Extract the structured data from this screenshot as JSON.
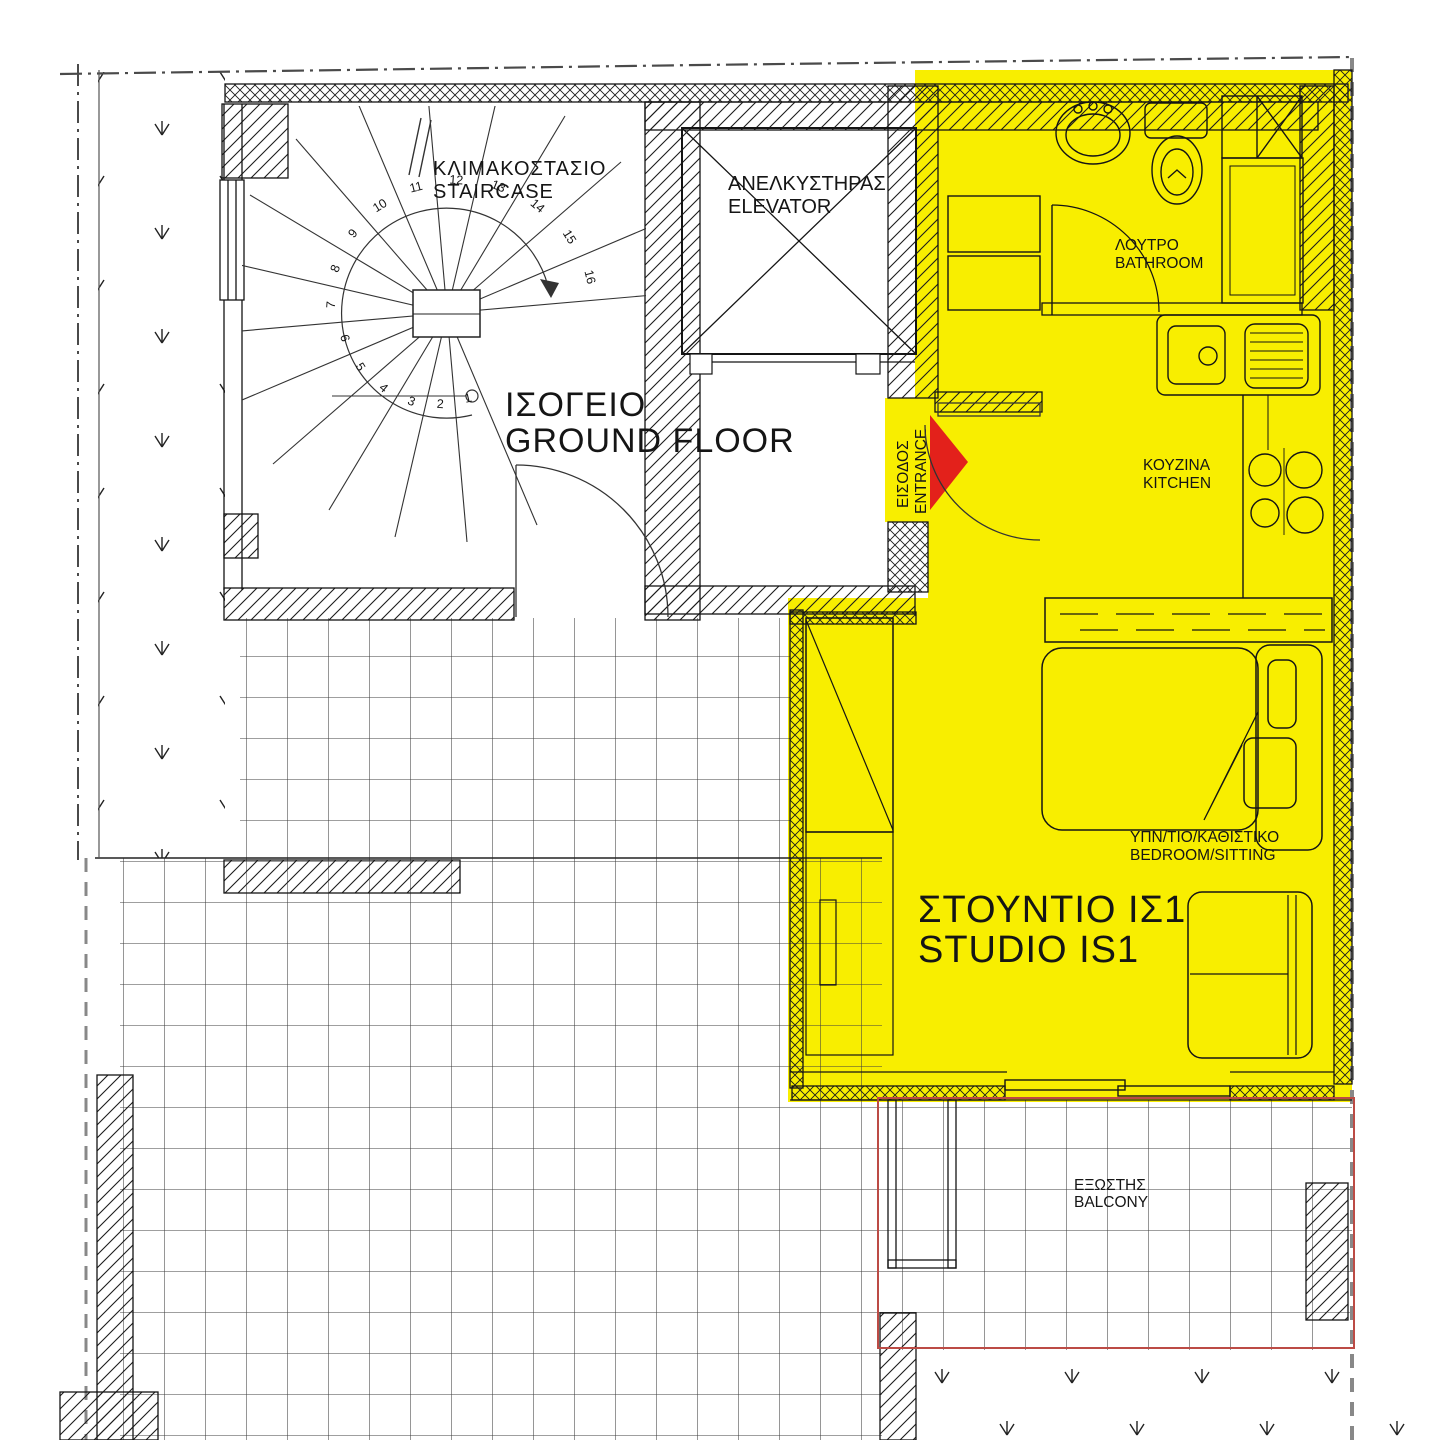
{
  "plan": {
    "colors": {
      "highlight_yellow": "#F8EE00",
      "arrow_red": "#E3211B",
      "balcony_red": "#BC4B45"
    },
    "floor": {
      "el": "ΙΣΟΓΕΙΟ",
      "en": "GROUND FLOOR"
    },
    "rooms": {
      "staircase": {
        "el": "ΚΛΙΜΑΚΟΣΤΑΣΙΟ",
        "en": "STAIRCASE"
      },
      "elevator": {
        "el": "ΑΝΕΛΚΥΣΤΗΡΑΣ",
        "en": "ELEVATOR"
      },
      "entrance": {
        "el": "ΕΙΣΟΔΟΣ",
        "en": "ENTRANCE"
      },
      "bathroom": {
        "el": "ΛΟΥΤΡΟ",
        "en": "BATHROOM"
      },
      "kitchen": {
        "el": "ΚΟΥΖΙΝΑ",
        "en": "KITCHEN"
      },
      "bedroom_sitting": {
        "el": "ΥΠΝ/ΤΙΟ/ΚΑΘΙΣΤΙΚΟ",
        "en": "BEDROOM/SITTING"
      },
      "studio": {
        "el": "ΣΤΟΥΝΤΙΟ ΙΣ1",
        "en": "STUDIO IS1"
      },
      "balcony": {
        "el": "ΕΞΩΣΤΗΣ",
        "en": "BALCONY"
      }
    },
    "stair_numbers": [
      "1",
      "2",
      "3",
      "4",
      "5",
      "6",
      "7",
      "8",
      "9",
      "10",
      "11",
      "12",
      "13",
      "14",
      "15",
      "16"
    ]
  }
}
